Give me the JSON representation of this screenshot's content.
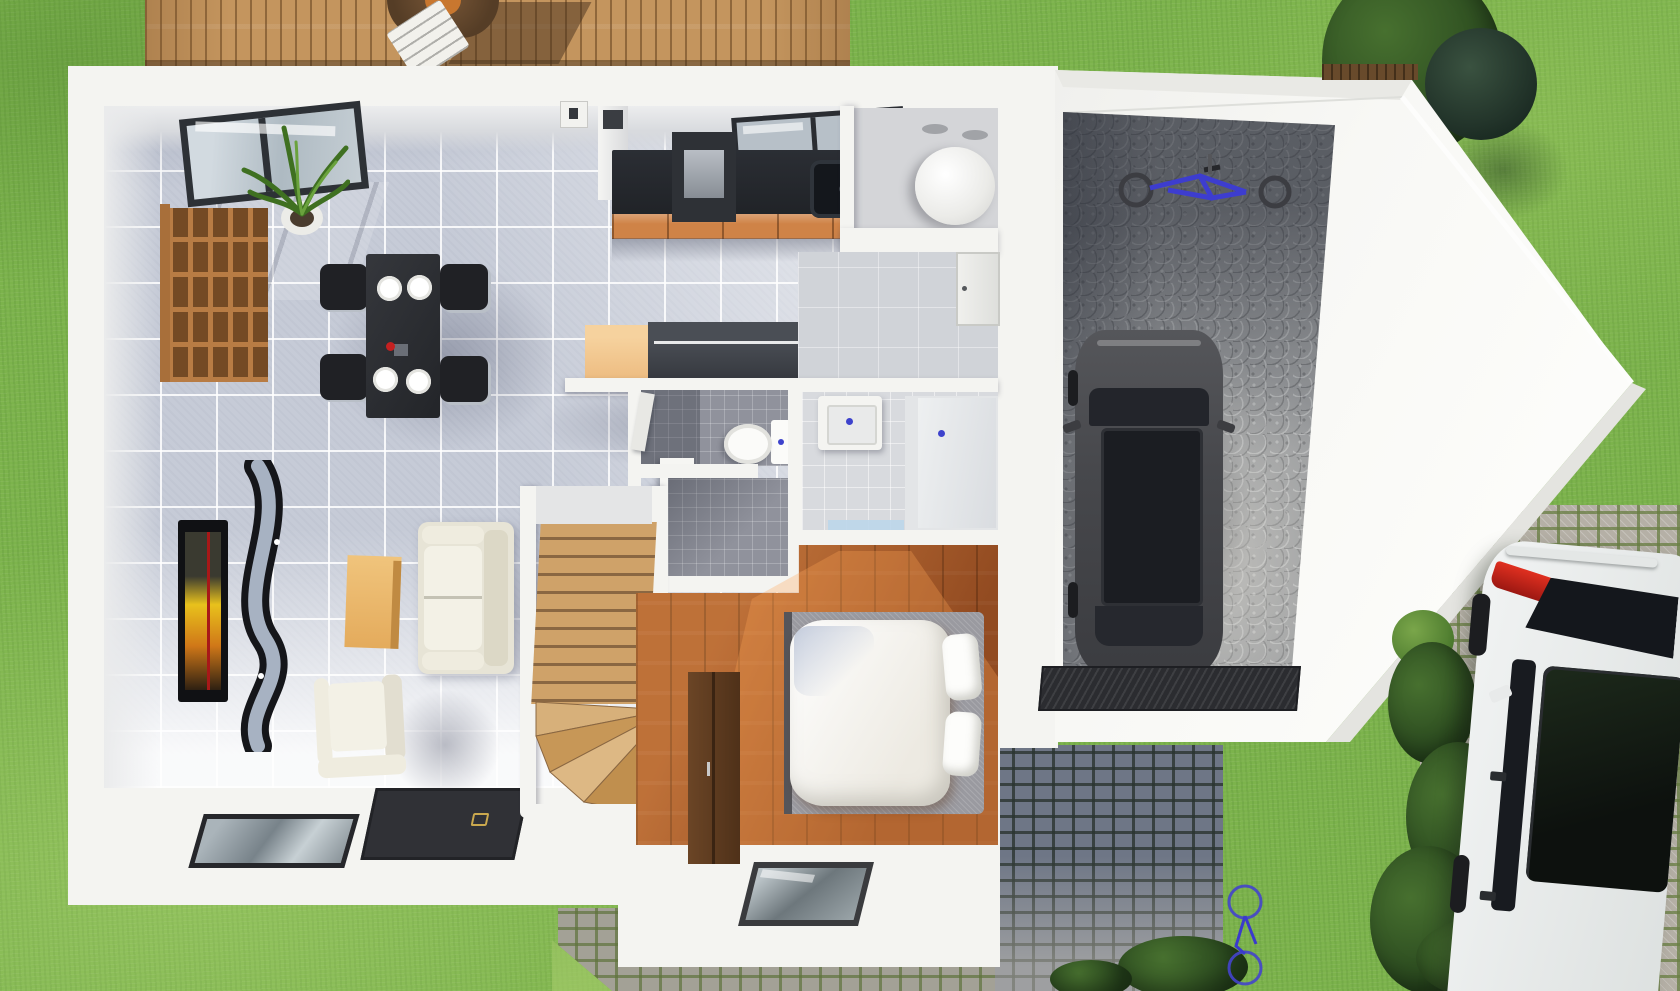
{
  "meta": {
    "type": "3d-floor-plan-top-view-render",
    "canvas": {
      "width": 1680,
      "height": 991
    }
  },
  "palette": {
    "grass": "#7cb34c",
    "deck_wood": "#c4955e",
    "wall_white": "#f4f4f1",
    "tile_floor": "#c6cbd7",
    "bedroom_wood": "#a2582a",
    "stairs_wood": "#cfa269",
    "kitchen_counter": "#24272c",
    "cabinet_orange": "#cf8347",
    "island_dark": "#33363c",
    "island_tan": "#ecb97d",
    "sofa_cream": "#efecdf",
    "garage_floor": "#9a9c9e",
    "car_black": "#47484c",
    "car_white": "#eef0f0",
    "taillight_red": "#d42a1e",
    "bike_blue": "#3a3acc",
    "cobble_stone": "#b5b0a6",
    "cobble_shadow": "#6e7686",
    "bush_green": "#35562a",
    "water_heater_white": "#fafaf8",
    "fixture_dot_blue": "#3d42cc",
    "tv_screen_yellow": "#e8c11c"
  },
  "exterior": {
    "garden": {
      "label": "Lawn and garden",
      "items": [
        {
          "label": "Tree cluster"
        },
        {
          "label": "Dark shrub"
        },
        {
          "label": "Hedge planter"
        }
      ]
    },
    "deck": {
      "label": "Wooden terrace",
      "items": [
        {
          "label": "Round patio table"
        },
        {
          "label": "White patio chair"
        }
      ]
    },
    "garage": {
      "label": "Garage",
      "items": [
        {
          "label": "Black car"
        },
        {
          "label": "Mountain bike on wall"
        },
        {
          "label": "Ribbed entry mat"
        }
      ]
    },
    "driveway": {
      "label": "Cobblestone driveway",
      "items": [
        {
          "label": "White car"
        },
        {
          "label": "Small bicycle"
        },
        {
          "label": "Shrub row"
        }
      ]
    }
  },
  "rooms": [
    {
      "id": "living-room",
      "label": "Living room",
      "items": [
        "Wall TV",
        "Curved TV stand",
        "Coffee table",
        "Two-seat sofa",
        "Armchair",
        "Cube shelving unit",
        "Potted plant",
        "Sliding glass door",
        "Floor glass panel",
        "Dark door mat"
      ]
    },
    {
      "id": "dining-area",
      "label": "Dining area",
      "items": [
        "Black dining table",
        "4 chairs",
        "4 white plates",
        "Red centerpiece"
      ]
    },
    {
      "id": "kitchen",
      "label": "Kitchen",
      "items": [
        "Black counter with sink",
        "Cooktop appliance",
        "Orange cabinet fronts",
        "Window",
        "Kitchen island",
        "Chimney pillar"
      ]
    },
    {
      "id": "laundry",
      "label": "Utility room",
      "items": [
        "Round water heater"
      ]
    },
    {
      "id": "hallway",
      "label": "Hallway",
      "items": [
        "Entry door",
        "Dark wall cabinet"
      ]
    },
    {
      "id": "wc",
      "label": "WC",
      "items": [
        "Toilet",
        "White bin",
        "Open door"
      ]
    },
    {
      "id": "bathroom",
      "label": "Bathroom",
      "items": [
        "Vanity basin",
        "Walk-in shower",
        "Glass screen"
      ]
    },
    {
      "id": "bedroom",
      "label": "Bedroom",
      "items": [
        "Double bed with white duvet",
        "Two pillows",
        "Dark wardrobe",
        "Floor glass panel"
      ]
    },
    {
      "id": "stairs",
      "label": "Staircase",
      "items": [
        "Wooden steps",
        "Winder treads"
      ]
    }
  ]
}
